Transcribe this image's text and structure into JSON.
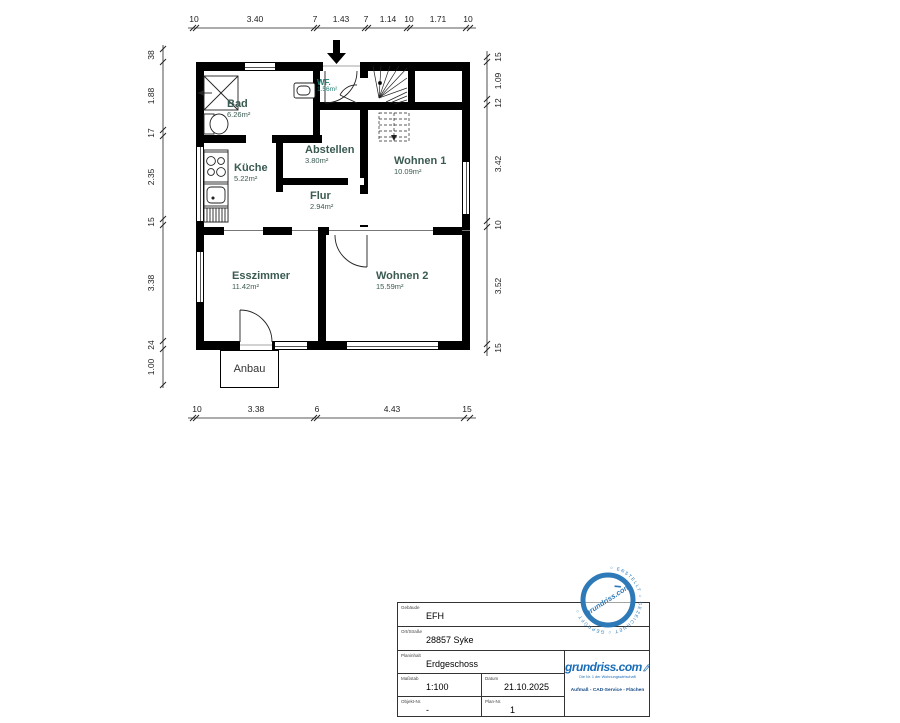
{
  "plan": {
    "rooms": [
      {
        "name": "Bad",
        "area": "6.26m²"
      },
      {
        "name": "WF.",
        "area": "1.56m²"
      },
      {
        "name": "Küche",
        "area": "5.22m²"
      },
      {
        "name": "Abstellen",
        "area": "3.80m²"
      },
      {
        "name": "Flur",
        "area": "2.94m²"
      },
      {
        "name": "Wohnen 1",
        "area": "10.09m²"
      },
      {
        "name": "Esszimmer",
        "area": "11.42m²"
      },
      {
        "name": "Wohnen 2",
        "area": "15.59m²"
      }
    ],
    "annex_label": "Anbau",
    "dimensions": {
      "top": [
        "10",
        "3.40",
        "7",
        "1.43",
        "7",
        "1.14",
        "10",
        "1.71",
        "10"
      ],
      "bottom": [
        "10",
        "3.38",
        "6",
        "4.43",
        "15"
      ],
      "left": [
        "38",
        "1.88",
        "17",
        "2.35",
        "15",
        "3.38",
        "24",
        "1.00"
      ],
      "right": [
        "15",
        "1.09",
        "12",
        "3.42",
        "10",
        "3.52",
        "15"
      ]
    }
  },
  "title_block": {
    "fields": [
      {
        "label": "Gebäude",
        "value": "EFH"
      },
      {
        "label": "Ort/Straße",
        "value": "28857 Syke"
      },
      {
        "label": "Planinhalt",
        "value": "Erdgeschoss"
      },
      {
        "label": "Maßstab",
        "value": "1:100"
      },
      {
        "label": "Datum",
        "value": "21.10.2025"
      },
      {
        "label": "Objekt-Nr.",
        "value": "-"
      },
      {
        "label": "Plan-Nr.",
        "value": "1"
      }
    ],
    "logo": {
      "brand": "grundriss.com",
      "tagline": "Die Nr. 1 der Wohnungswirtschaft",
      "services": "Aufmaß - CAD-Service - Flächen"
    }
  },
  "stamp": {
    "ring_text": "○ ERSTELLT ○ GEZEICHNET ○ GEPRÜFT ○",
    "center_text": "grundriss.com"
  },
  "colors": {
    "room_label": "#3a5a52",
    "logo_blue": "#1a6db8",
    "wall": "#000000"
  }
}
